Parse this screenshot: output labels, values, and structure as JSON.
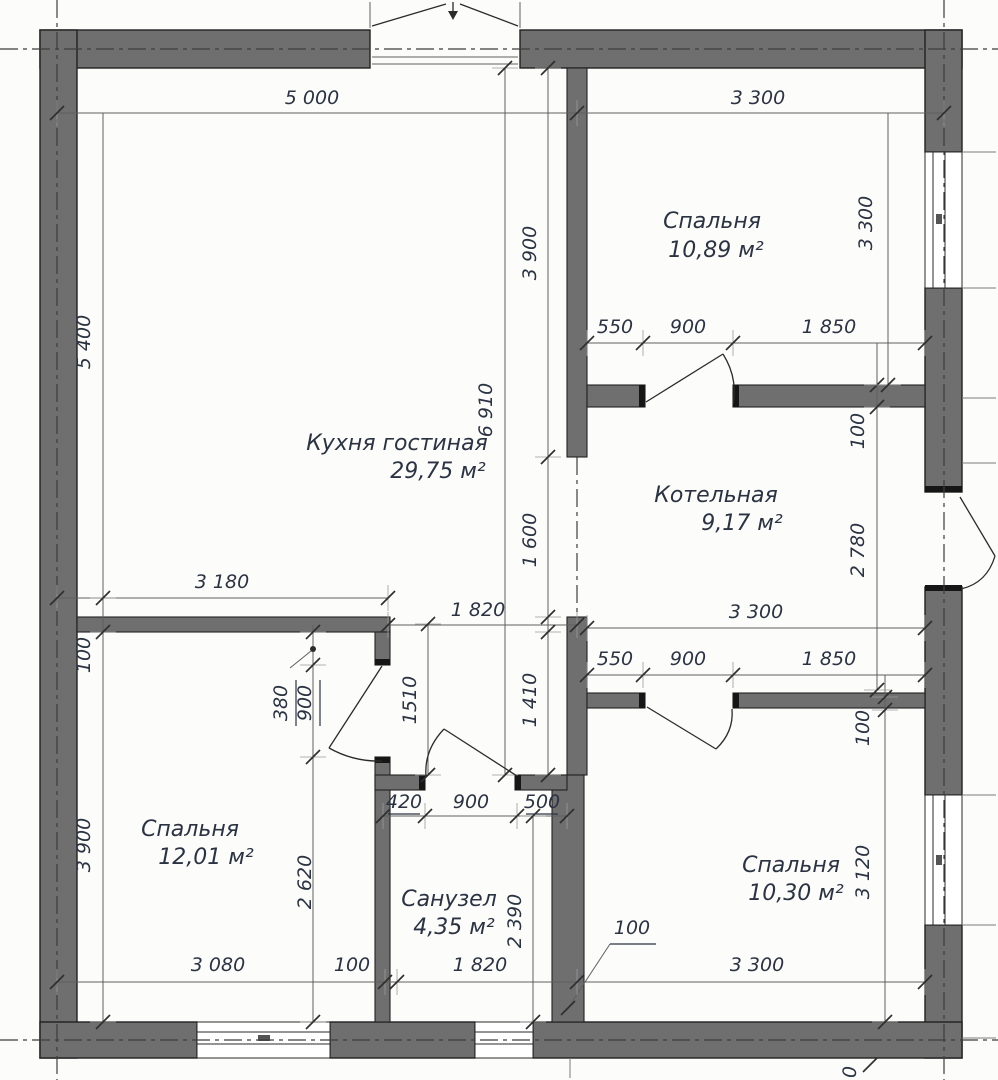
{
  "rooms": {
    "kitchen": {
      "name": "Кухня гостиная",
      "area": "29,75 м²"
    },
    "bedroom_top": {
      "name": "Спальня",
      "area": "10,89 м²"
    },
    "boiler": {
      "name": "Котельная",
      "area": "9,17 м²"
    },
    "bedroom_left": {
      "name": "Спальня",
      "area": "12,01 м²"
    },
    "bathroom": {
      "name": "Санузел",
      "area": "4,35 м²"
    },
    "bedroom_bottom": {
      "name": "Спальня",
      "area": "10,30 м²"
    }
  },
  "dims": {
    "top_left": "5 000",
    "top_right": "3 300",
    "kitchen_width": "3 180",
    "hall_width": "1 820",
    "left_upper": "5 400",
    "left_thk": "100",
    "left_lower": "3 900",
    "center_upper": "3 900",
    "center_opening": "1 600",
    "center_total": "6 910",
    "hall_left": "1510",
    "hall_right": "1 410",
    "bedroom_top_height": "3 300",
    "boiler_chain": [
      "550",
      "900",
      "1 850"
    ],
    "boiler_thk": "100",
    "boiler_height": "2 780",
    "boiler_width": "3 300",
    "bedroom_bottom_chain": [
      "550",
      "900",
      "1 850"
    ],
    "bedroom_bottom_thk": "100",
    "bedroom_bottom_height": "3 120",
    "door_offset": "380",
    "door_width": "900",
    "below_door": "2 620",
    "bath_chain": [
      "420",
      "900",
      "500"
    ],
    "bath_height": "2 390",
    "bath_width": "1 820",
    "bottom_left_width": "3 080",
    "bottom_thk": "100",
    "wall_leader": "100",
    "bottom_right_width": "3 300",
    "edge_left": "90",
    "edge_bottom": "0"
  },
  "colors": {
    "wall": "#6f6f6f",
    "ink": "#2b3342"
  }
}
